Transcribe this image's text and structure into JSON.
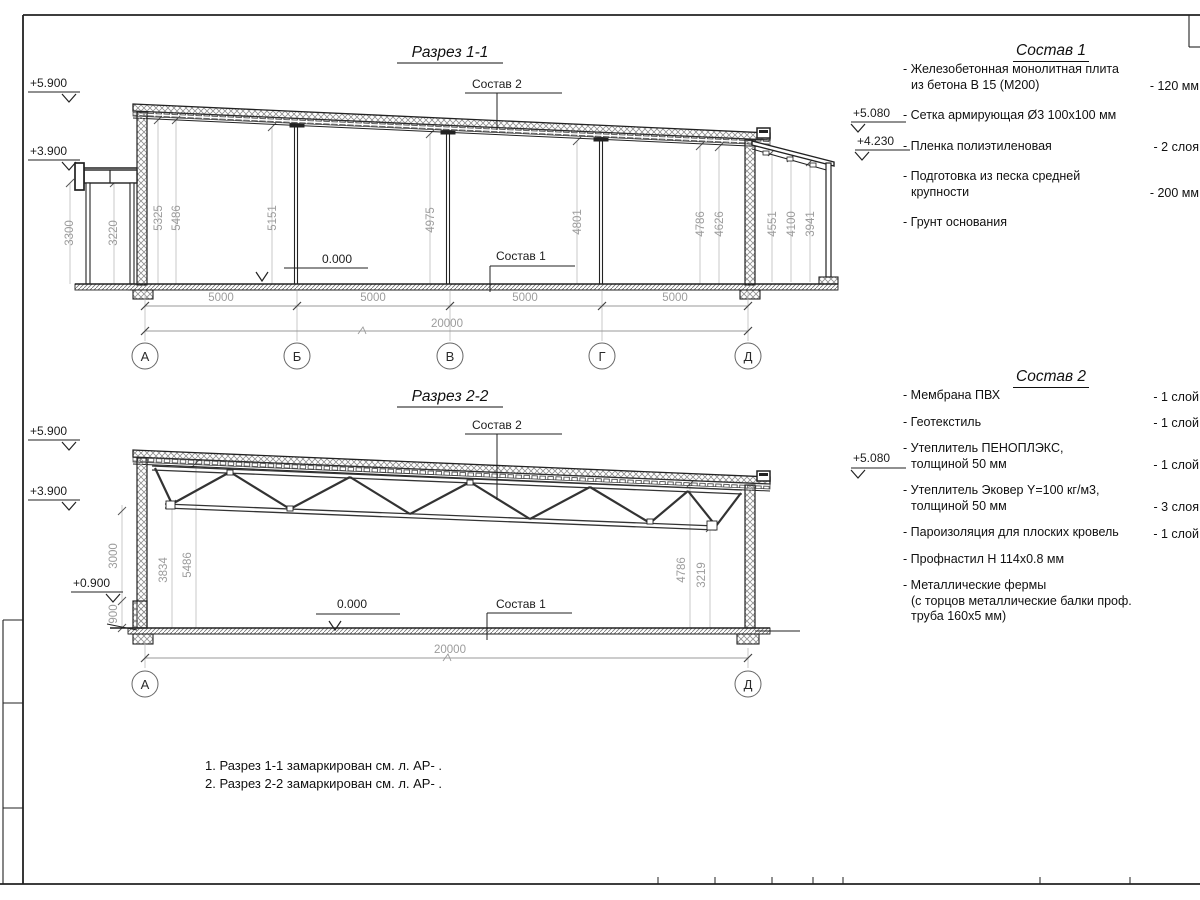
{
  "section1": {
    "title": "Разрез 1-1",
    "elevations": {
      "left_top": "+5.900",
      "left_mid": "+3.900",
      "right_top": "+5.080",
      "right_mid": "+4.230"
    },
    "zero_level": "0.000",
    "labels": {
      "sostav2": "Состав 2",
      "sostav1": "Состав 1"
    },
    "dims_vertical": [
      "3300",
      "3220",
      "5325",
      "5486",
      "5151",
      "4975",
      "4801",
      "4786",
      "4626",
      "4551",
      "4100",
      "3941"
    ],
    "dims_bottom": [
      "5000",
      "5000",
      "5000",
      "5000"
    ],
    "dim_total": "20000",
    "axes": [
      "А",
      "Б",
      "В",
      "Г",
      "Д"
    ]
  },
  "section2": {
    "title": "Разрез 2-2",
    "elevations": {
      "left_top": "+5.900",
      "left_mid": "+3.900",
      "left_low": "+0.900",
      "right_top": "+5.080"
    },
    "zero_level": "0.000",
    "labels": {
      "sostav2": "Состав 2",
      "sostav1": "Состав 1"
    },
    "dims_vertical": [
      "3000",
      "900",
      "3834",
      "5486",
      "4786",
      "3219"
    ],
    "dim_total": "20000",
    "axes": [
      "А",
      "Д"
    ]
  },
  "sostav1": {
    "title": "Состав 1",
    "items": [
      {
        "text": "- Железобетонная  монолитная плита\nиз бетона В 15 (М200)",
        "value": "- 120 мм"
      },
      {
        "text": "- Сетка армирующая Ø3 100х100 мм"
      },
      {
        "text": "- Пленка полиэтиленовая",
        "value": "- 2 слоя"
      },
      {
        "text": "- Подготовка из песка средней\nкрупности",
        "value": "- 200 мм"
      },
      {
        "text": "- Грунт основания"
      }
    ]
  },
  "sostav2": {
    "title": "Состав 2",
    "items": [
      {
        "text": "- Мембрана ПВХ",
        "value": "- 1 слой"
      },
      {
        "text": "- Геотекстиль",
        "value": "- 1 слой"
      },
      {
        "text": "- Утеплитель ПЕНОПЛЭКС,\nтолщиной 50 мм",
        "value": "- 1 слой"
      },
      {
        "text": "- Утеплитель Эковер Y=100 кг/м3,\nтолщиной 50 мм",
        "value": "- 3 слоя"
      },
      {
        "text": "- Пароизоляция для плоских кровель",
        "value": "- 1 слой"
      },
      {
        "text": "- Профнастил Н 114х0.8 мм"
      },
      {
        "text": "- Металлические фермы\n(с торцов металлические балки проф.\nтруба 160х5 мм)"
      }
    ]
  },
  "notes": [
    "1. Разрез 1-1 замаркирован см. л. АР- .",
    "2. Разрез 2-2 замаркирован см. л. АР- ."
  ]
}
